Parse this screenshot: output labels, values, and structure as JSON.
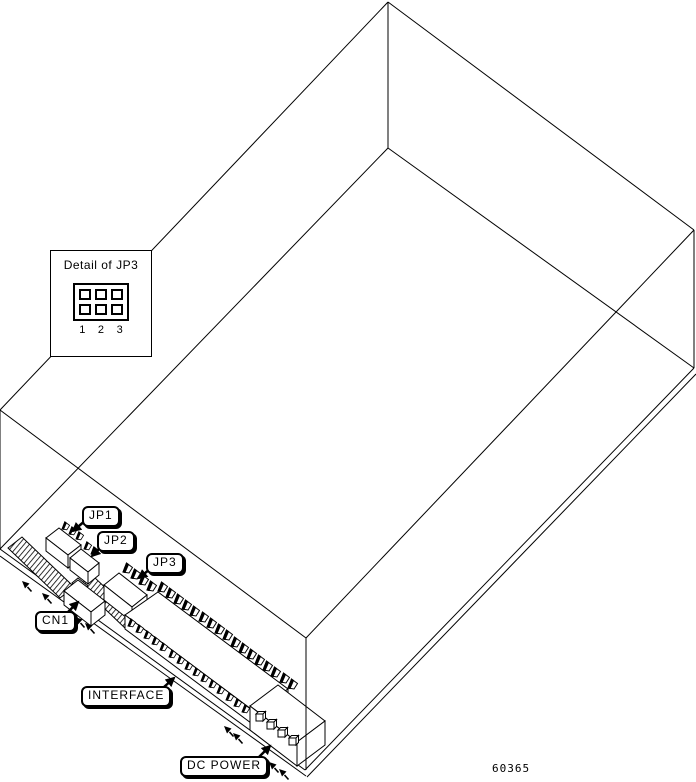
{
  "diagram": {
    "part_number": "60365",
    "inset": {
      "title": "Detail of JP3",
      "pin_numbers": [
        "1",
        "2",
        "3"
      ],
      "jumper_rows": 2,
      "jumper_cols": 3
    },
    "callouts": {
      "jp1": "JP1",
      "jp2": "JP2",
      "jp3": "JP3",
      "cn1": "CN1",
      "interface": "INTERFACE",
      "dc_power": "DC POWER"
    },
    "colors": {
      "line": "#000000",
      "background": "#ffffff"
    }
  }
}
